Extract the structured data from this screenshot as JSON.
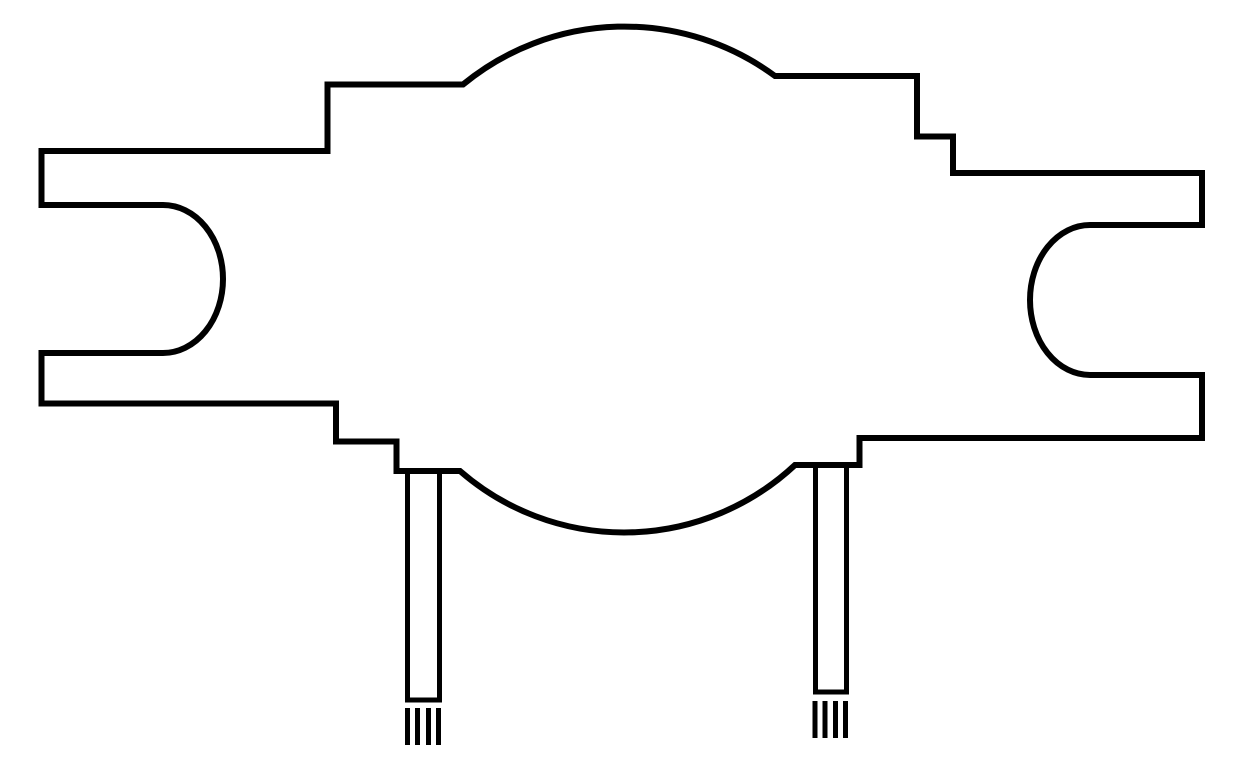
{
  "canvas": {
    "width": 1239,
    "height": 783,
    "background": "#ffffff",
    "stroke_color": "#000000"
  },
  "drawing": {
    "outline_stroke_width": 6,
    "lead_stroke_width": 5,
    "hatch_stroke_width": 5
  },
  "paths": {
    "body_outline": "M 41.5 151 H 327.5 V 84.5 H 463 A 254 254 0 0 1 775 76 H 917 V 136.5 H 953 V 173 H 1202 V 225 H 1090 A 60 75 0 0 0 1090 375 H 1202 V 438 H 859.5 V 465 H 795 A 250 250 0 0 1 460 471 H 396.5 V 441.5 H 336 V 403.5 H 41.5 V 353 H 163 A 60 74 0 0 0 163 205 H 41.5 Z",
    "left_lead_pin": "M 407.5 470 V 700 H 439.5 V 470",
    "right_lead_pin": "M 815.5 466 V 692 H 846.5 V 466",
    "left_lead_hatching": "M 407.5 708 V 745 M 417.5 708 V 745 M 428.5 708 V 745 M 438.5 708 V 745",
    "right_lead_hatching": "M 815 701 V 738 M 825 701 V 738 M 835.5 701 V 738 M 845.5 701 V 738"
  }
}
